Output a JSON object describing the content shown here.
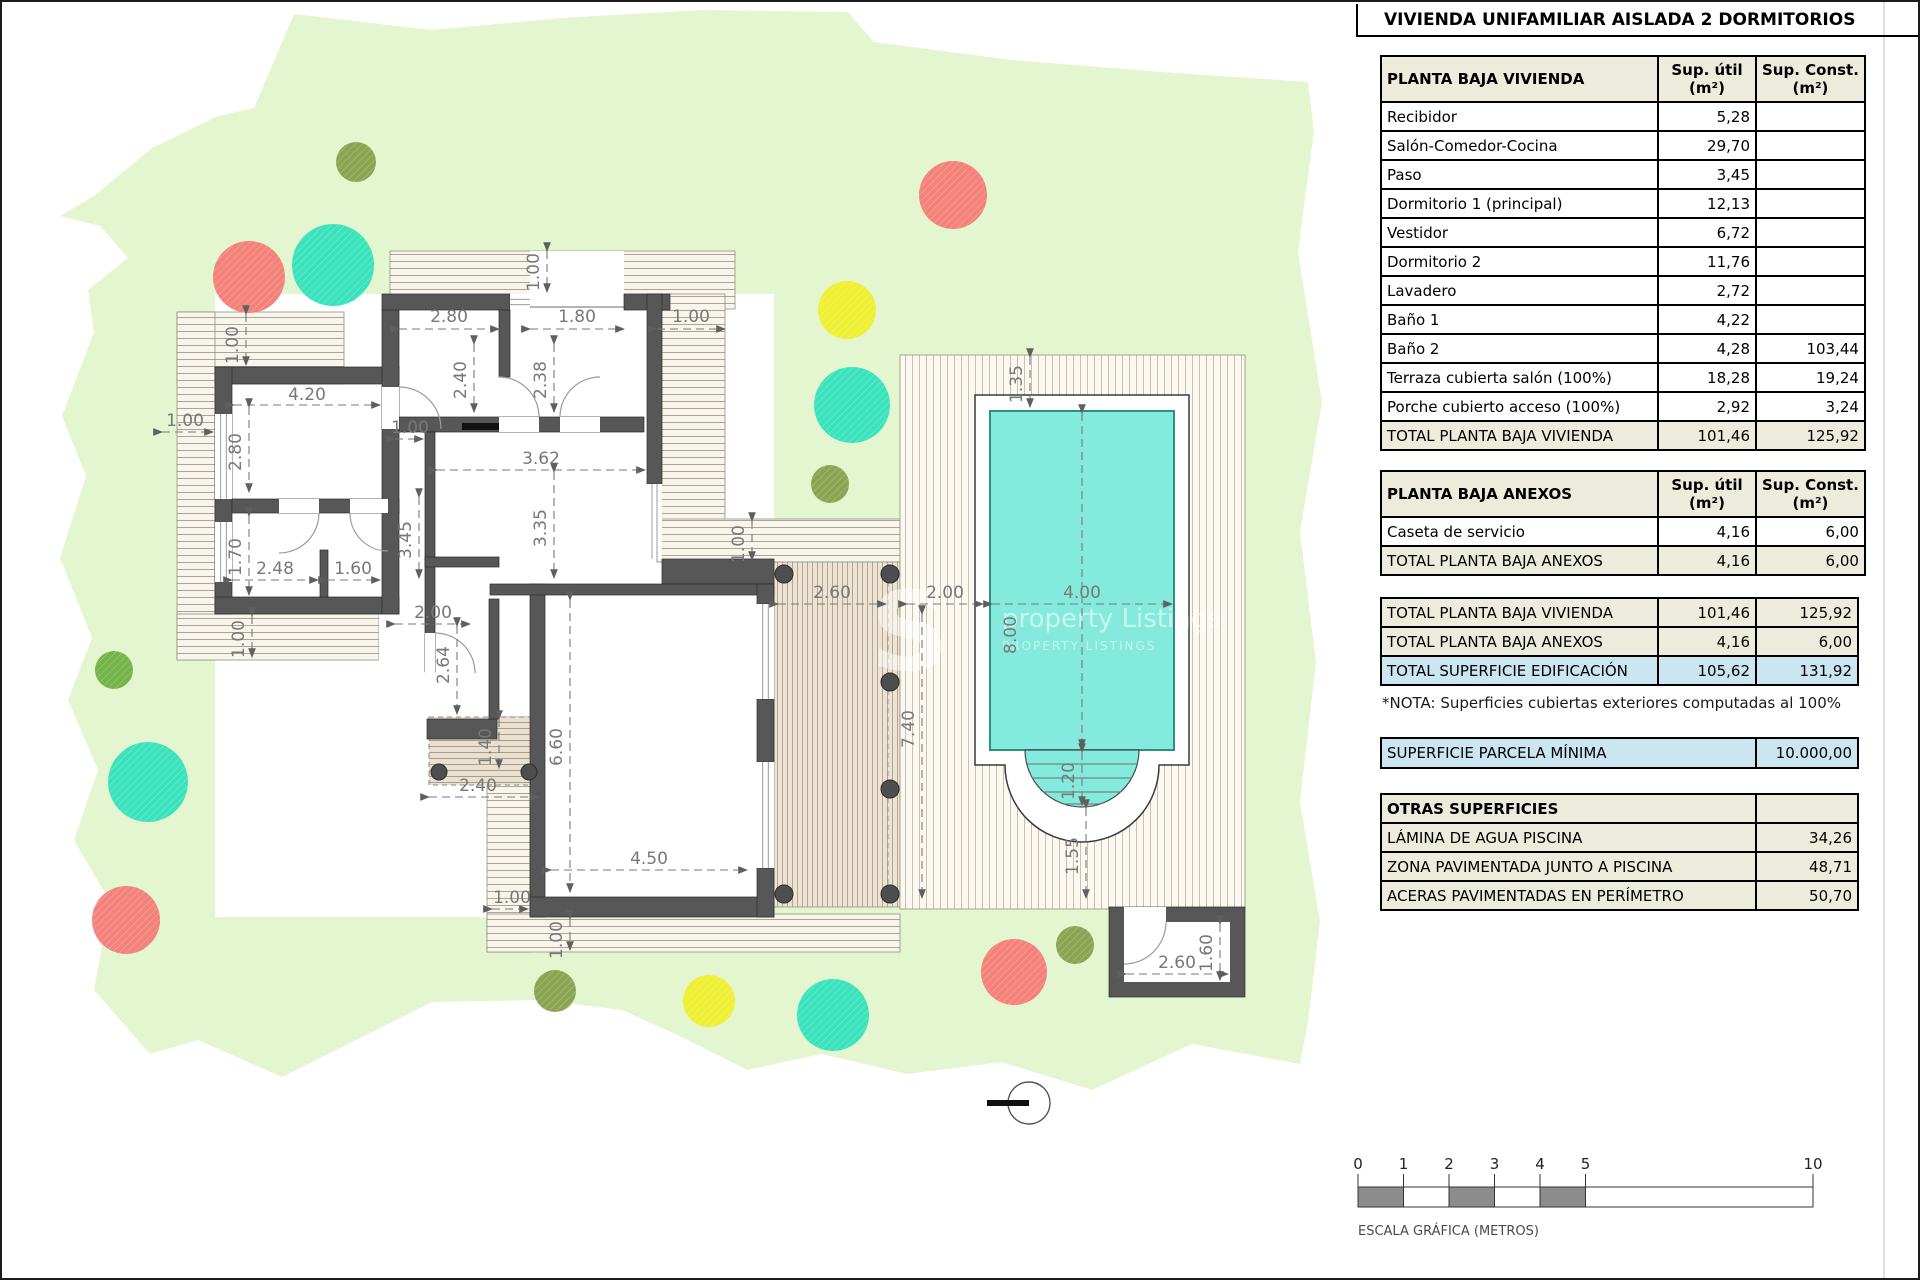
{
  "title": "VIVIENDA UNIFAMILIAR AISLADA 2 DORMITORIOS",
  "tables": {
    "vivienda": {
      "header": "PLANTA BAJA VIVIENDA",
      "col_util_1": "Sup. útil",
      "col_util_2": "(m²)",
      "col_const_1": "Sup. Const.",
      "col_const_2": "(m²)",
      "rows": [
        [
          "Recibidor",
          "5,28",
          ""
        ],
        [
          "Salón-Comedor-Cocina",
          "29,70",
          ""
        ],
        [
          "Paso",
          "3,45",
          ""
        ],
        [
          "Dormitorio 1 (principal)",
          "12,13",
          ""
        ],
        [
          "Vestidor",
          "6,72",
          ""
        ],
        [
          "Dormitorio 2",
          "11,76",
          ""
        ],
        [
          "Lavadero",
          "2,72",
          ""
        ],
        [
          "Baño 1",
          "4,22",
          ""
        ],
        [
          "Baño 2",
          "4,28",
          "103,44"
        ],
        [
          "Terraza cubierta salón (100%)",
          "18,28",
          "19,24"
        ],
        [
          "Porche cubierto acceso (100%)",
          "2,92",
          "3,24"
        ]
      ],
      "total": [
        "TOTAL PLANTA BAJA VIVIENDA",
        "101,46",
        "125,92"
      ]
    },
    "anexos": {
      "header": "PLANTA BAJA ANEXOS",
      "col_util_1": "Sup. útil",
      "col_util_2": "(m²)",
      "col_const_1": "Sup. Const.",
      "col_const_2": "(m²)",
      "rows": [
        [
          "Caseta de servicio",
          "4,16",
          "6,00"
        ]
      ],
      "total": [
        "TOTAL PLANTA BAJA ANEXOS",
        "4,16",
        "6,00"
      ]
    },
    "totales": [
      {
        "label": "TOTAL PLANTA BAJA VIVIENDA",
        "util": "101,46",
        "const": "125,92",
        "style": "beige"
      },
      {
        "label": "TOTAL PLANTA BAJA ANEXOS",
        "util": "4,16",
        "const": "6,00",
        "style": "beige"
      },
      {
        "label": "TOTAL SUPERFICIE EDIFICACIÓN",
        "util": "105,62",
        "const": "131,92",
        "style": "blue"
      }
    ],
    "nota": "*NOTA: Superficies cubiertas exteriores computadas al 100%",
    "parcela": {
      "label": "SUPERFICIE PARCELA MÍNIMA",
      "value": "10.000,00"
    },
    "otras": {
      "header": "OTRAS SUPERFICIES",
      "rows": [
        [
          "LÁMINA DE AGUA PISCINA",
          "34,26"
        ],
        [
          "ZONA PAVIMENTADA JUNTO A PISCINA",
          "48,71"
        ],
        [
          "ACERAS PAVIMENTADAS EN PERÍMETRO",
          "50,70"
        ]
      ]
    }
  },
  "scale_bar": {
    "label": "ESCALA GRÁFICA (METROS)",
    "ticks": [
      {
        "t": "0",
        "m": 0
      },
      {
        "t": "1",
        "m": 1
      },
      {
        "t": "2",
        "m": 2
      },
      {
        "t": "3",
        "m": 3
      },
      {
        "t": "4",
        "m": 4
      },
      {
        "t": "5",
        "m": 5
      },
      {
        "t": "10",
        "m": 10
      }
    ],
    "x0": 1356,
    "px_per_m": 45.5,
    "bar_y": 1185,
    "bar_h": 20,
    "gray_segments": [
      [
        0,
        1
      ],
      [
        2,
        3
      ],
      [
        4,
        5
      ]
    ]
  },
  "watermark": {
    "glyph": "S",
    "line1": "property Listings",
    "line2": "PROPERTY LISTINGS"
  },
  "plan": {
    "colors": {
      "lawn": "#E4F6CF",
      "deckBg": "#F8F5EC",
      "deckLine": "#ACA496",
      "terrBg": "#ECE3D4",
      "terrLine": "#B4A58E",
      "poolDeckBg": "#FBF9F2",
      "poolDeckLine": "#C8C1B1",
      "wall": "#575757",
      "wallEdge": "#2B2B2B",
      "water": "#84EADD",
      "waterEdge": "#2E8F86",
      "dim": "#787878",
      "post": "#4E4E4E",
      "thin": "#9B9B9B",
      "red": "#F4827B",
      "teal": "#3BE3BD",
      "yellow": "#EFEF33",
      "green": "#74B44A",
      "olive": "#8CA452"
    },
    "lawn_points": "292,12 430,28 560,16 700,8 846,10 872,40 1010,58 1160,70 1306,80 1312,130 1296,250 1320,400 1298,530 1314,660 1298,800 1318,920 1306,1020 1298,1062 1190,1042 1090,1088 1000,1060 905,1072 820,1052 745,1068 680,1035 620,1008 540,998 430,1000 370,1030 280,1075 196,1038 148,1052 92,988 108,900 72,838 96,768 66,698 90,636 58,556 84,474 60,414 92,330 86,288 126,256 98,224 58,214 92,194 150,146 216,114 252,106",
    "backing": [
      213,
      292,
      559,
      623
    ],
    "decks": [
      [
        388,
        249,
        345,
        58
      ],
      [
        175,
        310,
        167,
        72
      ],
      [
        175,
        310,
        38,
        348
      ],
      [
        175,
        612,
        202,
        46
      ],
      [
        655,
        292,
        68,
        268
      ],
      [
        655,
        517,
        243,
        43
      ],
      [
        485,
        715,
        43,
        235
      ],
      [
        485,
        912,
        413,
        38
      ]
    ],
    "court": [
      377,
      540,
      108,
      243
    ],
    "porch": [
      528,
      249,
      94,
      59
    ],
    "terrace": [
      772,
      560,
      126,
      345
    ],
    "pergola": [
      427,
      715,
      110,
      68
    ],
    "pool_deck": [
      898,
      353,
      345,
      554
    ],
    "paved_path": "M973,393 H1187 V763 H1157 A77,77 0 0 1 1003,763 H973 Z",
    "water": [
      988,
      409,
      184,
      339
    ],
    "steps_path": "M1023,748 A57,57 0 0 0 1137,748 Z",
    "step_lines": [
      [
        1025,
        762,
        1135,
        762
      ],
      [
        1030,
        776,
        1130,
        776
      ],
      [
        1041,
        790,
        1119,
        790
      ],
      [
        1062,
        802,
        1098,
        802
      ]
    ],
    "walls": [
      [
        213,
        365,
        184,
        17
      ],
      [
        213,
        365,
        17,
        247
      ],
      [
        213,
        595,
        184,
        17
      ],
      [
        230,
        497,
        167,
        14
      ],
      [
        318,
        548,
        8,
        47
      ],
      [
        380,
        308,
        17,
        304
      ],
      [
        380,
        292,
        128,
        16
      ],
      [
        622,
        292,
        46,
        16
      ],
      [
        645,
        292,
        15,
        190
      ],
      [
        660,
        557,
        112,
        25
      ],
      [
        497,
        308,
        11,
        67
      ],
      [
        397,
        415,
        245,
        15
      ],
      [
        423,
        430,
        10,
        240
      ],
      [
        425,
        717,
        70,
        20
      ],
      [
        487,
        597,
        10,
        120
      ],
      [
        423,
        555,
        74,
        10
      ],
      [
        528,
        582,
        15,
        333
      ],
      [
        488,
        582,
        284,
        11
      ],
      [
        528,
        895,
        244,
        20
      ],
      [
        755,
        582,
        17,
        20
      ],
      [
        755,
        697,
        17,
        63
      ],
      [
        755,
        866,
        17,
        49
      ]
    ],
    "caseta": {
      "outer": [
        1107,
        905,
        136,
        90
      ],
      "inner": [
        1122,
        920,
        106,
        60
      ]
    },
    "white_gaps": [
      [
        380,
        385,
        17,
        42
      ],
      [
        497,
        415,
        40,
        15
      ],
      [
        558,
        415,
        40,
        15
      ],
      [
        277,
        497,
        40,
        14
      ],
      [
        348,
        497,
        38,
        14
      ],
      [
        423,
        631,
        10,
        40
      ],
      [
        213,
        412,
        17,
        85
      ],
      [
        213,
        520,
        17,
        60
      ],
      [
        508,
        292,
        20,
        16
      ],
      [
        645,
        482,
        15,
        75
      ],
      [
        755,
        602,
        17,
        95
      ],
      [
        755,
        760,
        17,
        106
      ],
      [
        1122,
        905,
        42,
        15
      ]
    ],
    "windows": [
      {
        "r": [
          213,
          412,
          17,
          85
        ],
        "o": "v"
      },
      {
        "r": [
          213,
          520,
          17,
          60
        ],
        "o": "v"
      },
      {
        "r": [
          508,
          292,
          20,
          16
        ],
        "o": "h"
      },
      {
        "r": [
          645,
          482,
          15,
          75
        ],
        "o": "v"
      },
      {
        "r": [
          755,
          602,
          17,
          95
        ],
        "o": "v"
      },
      {
        "r": [
          755,
          760,
          17,
          106
        ],
        "o": "v"
      }
    ],
    "lintel": [
      528,
      305,
      622,
      305
    ],
    "counter": [
      460,
      421,
      37,
      7
    ],
    "arcs": [
      "M397 385 A42 42 0 0 1 439 427",
      "M497 375 A40 40 0 0 1 537 415",
      "M598 375 A40 40 0 0 0 558 415",
      "M317 511 A40 40 0 0 1 277 551",
      "M348 511 A38 38 0 0 0 386 549",
      "M433 631 A40 40 0 0 1 473 671",
      "M1164 920 A42 42 0 0 1 1122 962"
    ],
    "posts": [
      [
        782,
        572,
        9
      ],
      [
        888,
        572,
        9
      ],
      [
        888,
        680,
        9
      ],
      [
        888,
        787,
        9
      ],
      [
        782,
        892,
        9
      ],
      [
        888,
        892,
        9
      ],
      [
        437,
        770,
        8
      ],
      [
        527,
        770,
        8
      ]
    ],
    "dash_edges": [
      [
        886,
        562,
        886,
        898
      ]
    ],
    "trees": [
      {
        "x": 354,
        "y": 160,
        "r": 20,
        "c": "olive"
      },
      {
        "x": 247,
        "y": 275,
        "r": 36,
        "c": "red"
      },
      {
        "x": 331,
        "y": 263,
        "r": 41,
        "c": "teal"
      },
      {
        "x": 951,
        "y": 193,
        "r": 34,
        "c": "red"
      },
      {
        "x": 845,
        "y": 308,
        "r": 29,
        "c": "yellow"
      },
      {
        "x": 850,
        "y": 403,
        "r": 38,
        "c": "teal"
      },
      {
        "x": 828,
        "y": 482,
        "r": 19,
        "c": "olive"
      },
      {
        "x": 112,
        "y": 668,
        "r": 19,
        "c": "green"
      },
      {
        "x": 146,
        "y": 780,
        "r": 40,
        "c": "teal"
      },
      {
        "x": 124,
        "y": 918,
        "r": 34,
        "c": "red"
      },
      {
        "x": 553,
        "y": 989,
        "r": 21,
        "c": "olive"
      },
      {
        "x": 707,
        "y": 999,
        "r": 26,
        "c": "yellow"
      },
      {
        "x": 831,
        "y": 1013,
        "r": 36,
        "c": "teal"
      },
      {
        "x": 1012,
        "y": 970,
        "r": 33,
        "c": "red"
      },
      {
        "x": 1073,
        "y": 943,
        "r": 19,
        "c": "olive"
      }
    ],
    "dims": [
      {
        "t": "2.80",
        "x": 447,
        "y": 320,
        "v": 0,
        "l": [
          397,
          327,
          497,
          327
        ]
      },
      {
        "t": "1.80",
        "x": 575,
        "y": 320,
        "v": 0,
        "l": [
          528,
          327,
          622,
          327
        ]
      },
      {
        "t": "1.00",
        "x": 689,
        "y": 320,
        "v": 0,
        "l": [
          655,
          327,
          723,
          327
        ]
      },
      {
        "t": "1.00",
        "x": 537,
        "y": 270,
        "v": 1,
        "l": [
          545,
          249,
          545,
          290
        ]
      },
      {
        "t": "1.00",
        "x": 236,
        "y": 343,
        "v": 1,
        "l": [
          244,
          312,
          244,
          363
        ]
      },
      {
        "t": "4.20",
        "x": 305,
        "y": 398,
        "v": 0,
        "l": [
          232,
          403,
          378,
          403
        ]
      },
      {
        "t": "2.80",
        "x": 239,
        "y": 450,
        "v": 1,
        "l": [
          247,
          405,
          247,
          490
        ]
      },
      {
        "t": "1.00",
        "x": 183,
        "y": 424,
        "v": 0,
        "l": [
          160,
          430,
          211,
          430
        ]
      },
      {
        "t": "2.40",
        "x": 464,
        "y": 378,
        "v": 1,
        "l": [
          472,
          342,
          472,
          410
        ]
      },
      {
        "t": "2.38",
        "x": 544,
        "y": 378,
        "v": 1,
        "l": [
          552,
          342,
          552,
          410
        ]
      },
      {
        "t": "1.00",
        "x": 408,
        "y": 431,
        "v": 0,
        "l": [
          393,
          437,
          421,
          437
        ]
      },
      {
        "t": "3.62",
        "x": 539,
        "y": 462,
        "v": 0,
        "l": [
          435,
          468,
          643,
          468
        ]
      },
      {
        "t": "3.45",
        "x": 409,
        "y": 538,
        "v": 1,
        "l": [
          417,
          495,
          417,
          576
        ]
      },
      {
        "t": "3.35",
        "x": 544,
        "y": 526,
        "v": 1,
        "l": [
          552,
          470,
          552,
          576
        ]
      },
      {
        "t": "1.70",
        "x": 239,
        "y": 555,
        "v": 1,
        "l": [
          247,
          514,
          247,
          593
        ]
      },
      {
        "t": "2.48",
        "x": 273,
        "y": 572,
        "v": 0,
        "l": [
          230,
          578,
          316,
          578
        ]
      },
      {
        "t": "1.60",
        "x": 351,
        "y": 572,
        "v": 0,
        "l": [
          325,
          578,
          378,
          578
        ]
      },
      {
        "t": "2.00",
        "x": 431,
        "y": 616,
        "v": 0,
        "l": [
          393,
          622,
          468,
          622
        ]
      },
      {
        "t": "2.64",
        "x": 447,
        "y": 663,
        "v": 1,
        "l": [
          455,
          624,
          455,
          712
        ]
      },
      {
        "t": "1.40",
        "x": 489,
        "y": 745,
        "v": 1,
        "l": [
          497,
          717,
          497,
          766
        ]
      },
      {
        "t": "2.40",
        "x": 476,
        "y": 789,
        "v": 0,
        "l": [
          427,
          795,
          537,
          795
        ]
      },
      {
        "t": "6.60",
        "x": 560,
        "y": 745,
        "v": 1,
        "l": [
          568,
          598,
          568,
          890
        ]
      },
      {
        "t": "4.50",
        "x": 647,
        "y": 862,
        "v": 0,
        "l": [
          549,
          868,
          745,
          868
        ]
      },
      {
        "t": "1.00",
        "x": 510,
        "y": 901,
        "v": 0,
        "l": [
          490,
          907,
          526,
          907
        ]
      },
      {
        "t": "1.00",
        "x": 560,
        "y": 938,
        "v": 1,
        "l": [
          568,
          917,
          568,
          948
        ]
      },
      {
        "t": "1.00",
        "x": 242,
        "y": 637,
        "v": 1,
        "l": [
          250,
          614,
          250,
          655
        ]
      },
      {
        "t": "2.60",
        "x": 830,
        "y": 596,
        "v": 0,
        "l": [
          776,
          602,
          884,
          602
        ]
      },
      {
        "t": "2.00",
        "x": 943,
        "y": 596,
        "v": 0,
        "l": [
          905,
          602,
          981,
          602
        ]
      },
      {
        "t": "4.00",
        "x": 1080,
        "y": 596,
        "v": 0,
        "l": [
          990,
          602,
          1170,
          602
        ]
      },
      {
        "t": "8.00",
        "x": 1014,
        "y": 633,
        "v": 1,
        "l": [
          1080,
          411,
          1080,
          746
        ]
      },
      {
        "t": "1.35",
        "x": 1020,
        "y": 382,
        "v": 1,
        "l": [
          1028,
          355,
          1028,
          405
        ]
      },
      {
        "t": "7.40",
        "x": 912,
        "y": 727,
        "v": 1,
        "l": [
          920,
          612,
          920,
          896
        ]
      },
      {
        "t": "1.00",
        "x": 742,
        "y": 542,
        "v": 1,
        "l": [
          750,
          519,
          750,
          558
        ]
      },
      {
        "t": "2.60",
        "x": 1175,
        "y": 966,
        "v": 0,
        "l": [
          1124,
          972,
          1226,
          972
        ]
      },
      {
        "t": "1.60",
        "x": 1210,
        "y": 951,
        "v": 1,
        "l": [
          1218,
          922,
          1218,
          978
        ]
      },
      {
        "t": "1.20",
        "x": 1072,
        "y": 779,
        "v": 1,
        "l": [
          1080,
          750,
          1080,
          803
        ]
      },
      {
        "t": "1.55",
        "x": 1076,
        "y": 854,
        "v": 1,
        "l": [
          1084,
          806,
          1084,
          896
        ]
      }
    ],
    "datum": {
      "x": 1027,
      "y": 1101,
      "r": 21
    },
    "gridline_x": 1882
  }
}
